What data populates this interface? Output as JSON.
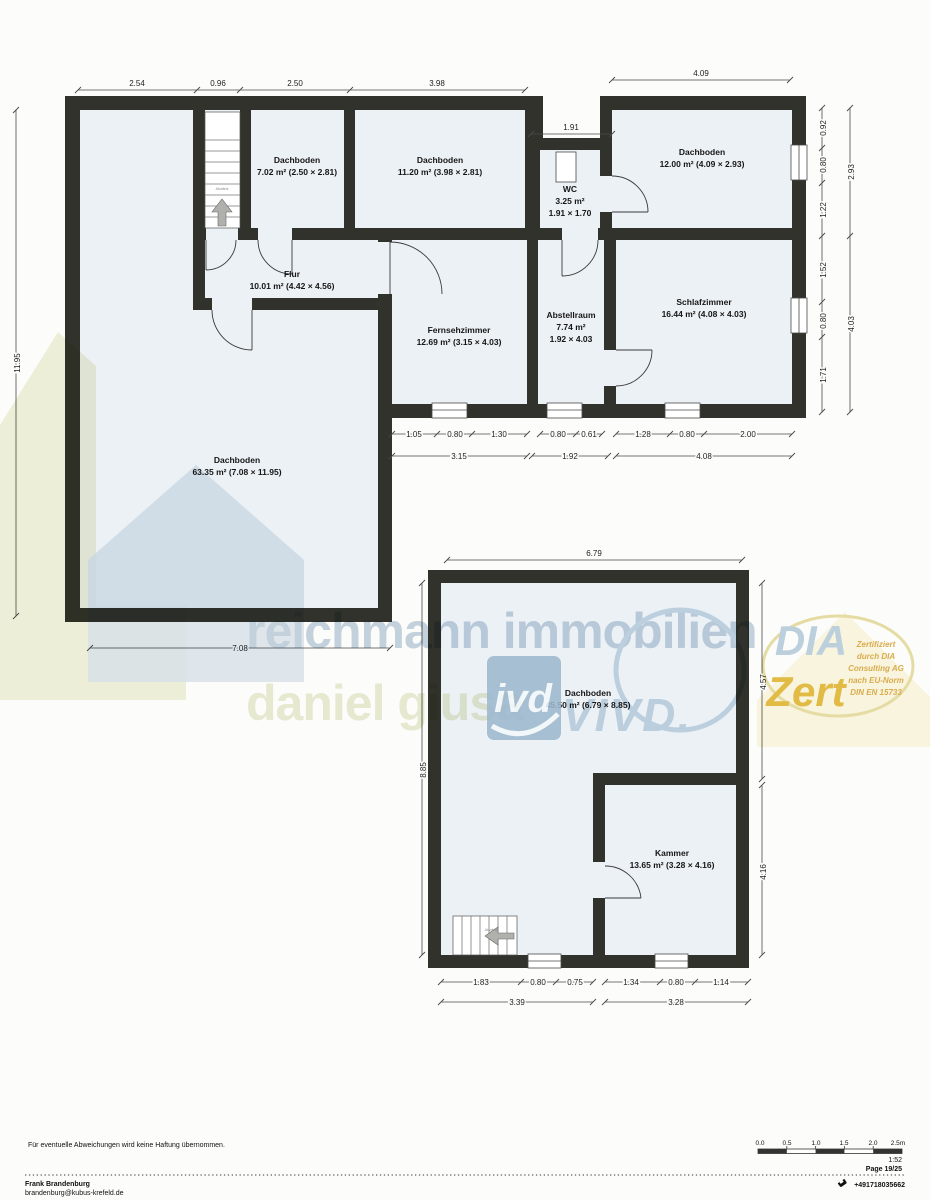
{
  "watermarks": {
    "brand_line1": "reichmann immobilien",
    "brand_line2": "daniel giusa",
    "ivd": "ivd",
    "vivd": "VIVD.",
    "dia": "DIA",
    "zert": "Zert",
    "cert_lines": [
      "Zertifiziert",
      "durch DIA",
      "Consulting AG",
      "nach EU-Norm",
      "DIN EN 15733"
    ]
  },
  "colors": {
    "wall": "#31322b",
    "room_fill": "#ecf1f5",
    "brand_blue": "#c6d4e1",
    "brand_green": "#e9ecd4",
    "ivd_blue": "#9db8cf",
    "zert_yellow": "#e4bd45"
  },
  "upper_plan": {
    "rooms": [
      {
        "id": "dachboden-702",
        "lines": [
          "Dachboden",
          "7.02 m² (2.50 × 2.81)"
        ]
      },
      {
        "id": "dachboden-1120",
        "lines": [
          "Dachboden",
          "11.20 m² (3.98 × 2.81)"
        ]
      },
      {
        "id": "wc",
        "lines": [
          "WC",
          "3.25 m²",
          "1.91 × 1.70"
        ]
      },
      {
        "id": "dachboden-1200",
        "lines": [
          "Dachboden",
          "12.00 m² (4.09 × 2.93)"
        ]
      },
      {
        "id": "flur",
        "lines": [
          "Flur",
          "10.01 m² (4.42 × 4.56)"
        ]
      },
      {
        "id": "fernsehzimmer",
        "lines": [
          "Fernsehzimmer",
          "12.69 m² (3.15 × 4.03)"
        ]
      },
      {
        "id": "abstellraum",
        "lines": [
          "Abstellraum",
          "7.74 m²",
          "1.92 × 4.03"
        ]
      },
      {
        "id": "schlafzimmer",
        "lines": [
          "Schlafzimmer",
          "16.44 m² (4.08 × 4.03)"
        ]
      },
      {
        "id": "dachboden-6335",
        "lines": [
          "Dachboden",
          "63.35 m² (7.08 × 11.95)"
        ]
      }
    ],
    "stair_label": "Abwärts",
    "dims": {
      "top": [
        "2.54",
        "0.96",
        "2.50",
        "3.98"
      ],
      "wc_top": "1.91",
      "right_top": "4.09",
      "right_inner": [
        "0.92",
        "0.80",
        "1.22",
        "1.52",
        "0.80",
        "1.71"
      ],
      "right_outer": [
        "2.93",
        "4.03"
      ],
      "left": "11.95",
      "bottom_row1": [
        "1.05",
        "0.80",
        "1.30",
        "0.80",
        "0.61",
        "1.28",
        "0.80",
        "2.00"
      ],
      "bottom_row2": [
        "3.15",
        "1.92",
        "4.08"
      ],
      "bottom_left": "7.08"
    }
  },
  "lower_plan": {
    "rooms": [
      {
        "id": "dachboden-4550",
        "lines": [
          "Dachboden",
          "45.50 m² (6.79 × 8.85)"
        ]
      },
      {
        "id": "kammer",
        "lines": [
          "Kammer",
          "13.65 m² (3.28 × 4.16)"
        ]
      }
    ],
    "stair_label": "Abwärts",
    "dims": {
      "top": "6.79",
      "left": "8.85",
      "right": [
        "4.57",
        "4.16"
      ],
      "bottom_row1": [
        "1.83",
        "0.80",
        "0.75",
        "1.34",
        "0.80",
        "1.14"
      ],
      "bottom_row2": [
        "3.39",
        "3.28"
      ]
    }
  },
  "footer": {
    "disclaimer": "Für eventuelle Abweichungen wird keine Haftung übernommen.",
    "contact_name": "Frank Brandenburg",
    "contact_email": "brandenburg@kubus-krefeld.de",
    "phone": "+491718035662",
    "scale_ratio": "1:52",
    "page_label": "Page 19/25",
    "scale_bar_labels": [
      "0.0",
      "0.5",
      "1.0",
      "1.5",
      "2.0",
      "2.5m"
    ]
  }
}
